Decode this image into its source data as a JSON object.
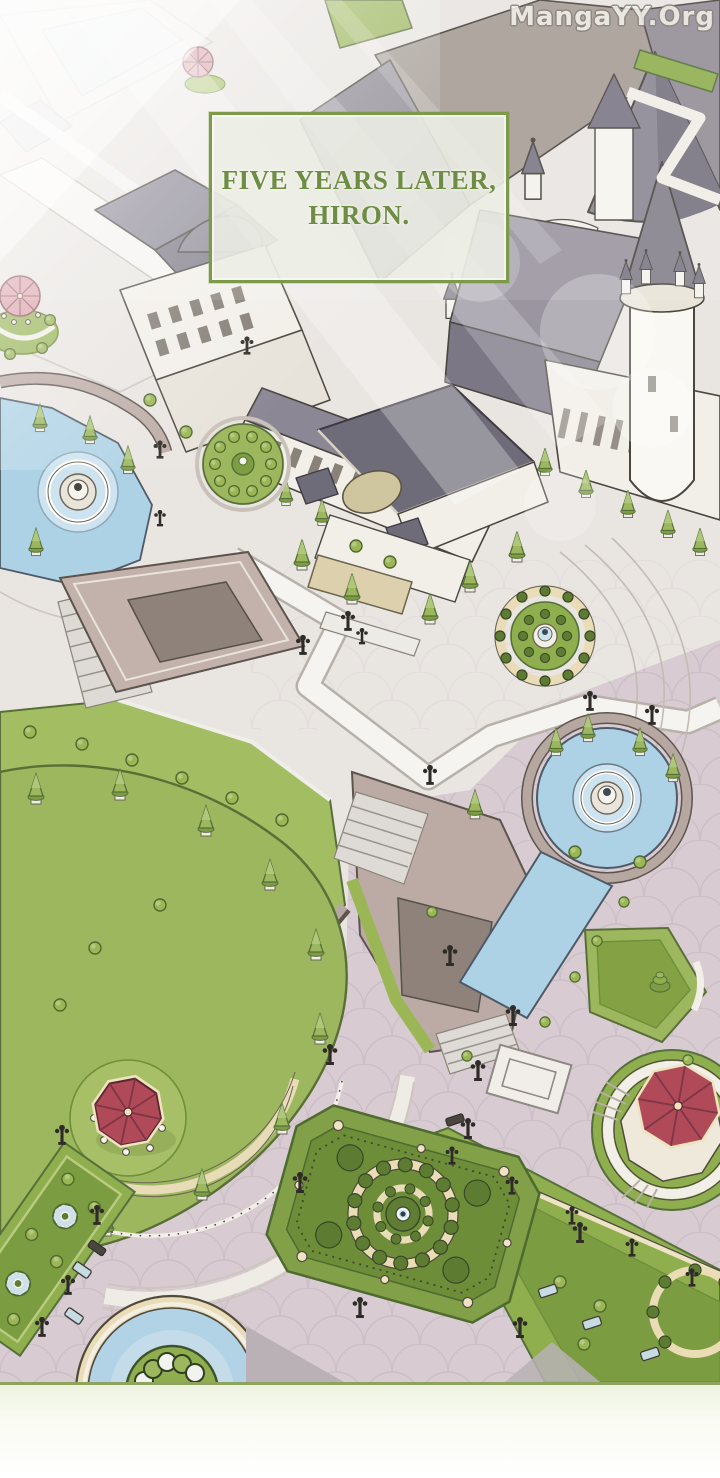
{
  "panel": {
    "caption": {
      "line1": "FIVE YEARS LATER,",
      "line2": "HIRON."
    },
    "watermark": {
      "text": "MangaYY.Org"
    },
    "scene": {
      "setting": "aerial isometric view of the Hiron imperial palace and its formal gardens",
      "elements": [
        "palace-with-spires",
        "round-white-tower",
        "entrance-pavilion-with-awning",
        "arcade-wing",
        "left-fountain-pool",
        "right-fountain-pool",
        "water-canal",
        "tree-ring-garden",
        "terraces-with-stairs",
        "crescent-lawn-garden",
        "red-roof-octagonal-gazebo",
        "pink-roof-gazebo",
        "central-parterre-garden",
        "side-parterre-beds",
        "circular-pond",
        "street-lamps",
        "benches",
        "topiary-trees",
        "scalloped-stone-plaza",
        "sunbeams"
      ]
    },
    "colors": {
      "caption_text": "#6d8c44",
      "caption_border": "#7d9a4b",
      "caption_bg": "rgba(236,238,229,0.88)",
      "water": "#aed2e5",
      "grass": "#8fae4e",
      "parterre_green": "#6d8d39",
      "pavement_upper": "#e9e5e1",
      "pavement_lower": "#d8ccd2",
      "roof_gray": "#8b8795",
      "roof_dark": "#6f6c79",
      "red_roof": "#b04a58",
      "pink_roof": "#dba3ab",
      "cream_stone": "#e9dcb6",
      "wall_mauve": "#b7a7a1",
      "watermark_fill": "#f3f0ea"
    }
  }
}
